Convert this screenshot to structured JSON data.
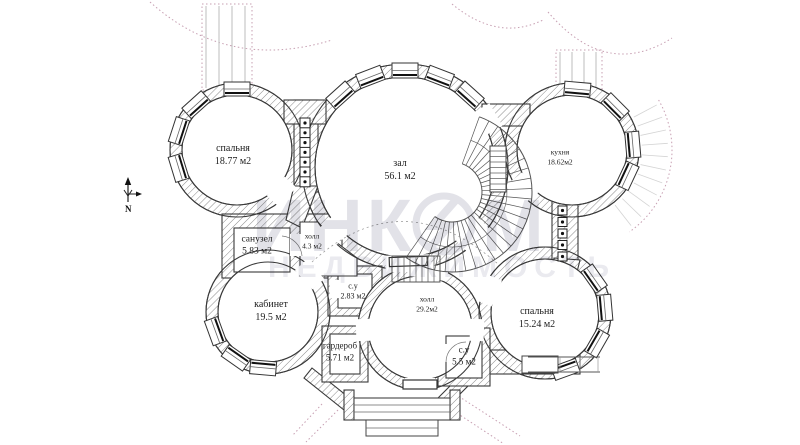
{
  "title": "floor-plan",
  "compass": {
    "north_label": "N"
  },
  "watermark": {
    "brand_part1": "ИНК",
    "brand_part2": "М",
    "brand_line2": "НЕДВИЖИМОСТЬ"
  },
  "rooms": [
    {
      "name": "спальня",
      "area": "18.77 м2"
    },
    {
      "name": "зал",
      "area": "56.1 м2"
    },
    {
      "name": "кухня",
      "area": "18.62м2"
    },
    {
      "name": "санузел",
      "area": "5.83 м2"
    },
    {
      "name": "холл",
      "area": "4.3 м2"
    },
    {
      "name": "кабинет",
      "area": "19.5 м2"
    },
    {
      "name": "с.у",
      "area": "2.83 м2"
    },
    {
      "name": "гардероб",
      "area": "5.71 м2"
    },
    {
      "name": "холл",
      "area": "29.2м2"
    },
    {
      "name": "спальня",
      "area": "15.24 м2"
    },
    {
      "name": "с.у",
      "area": "5.5 м2"
    }
  ],
  "colors": {
    "wall_line": "#3a3a3a",
    "hatch_line": "#8a8a8a",
    "decor_dashed": "#c79fb2",
    "steps_gray": "#bdbdbd",
    "watermark_gray": "#e2e2e8"
  }
}
